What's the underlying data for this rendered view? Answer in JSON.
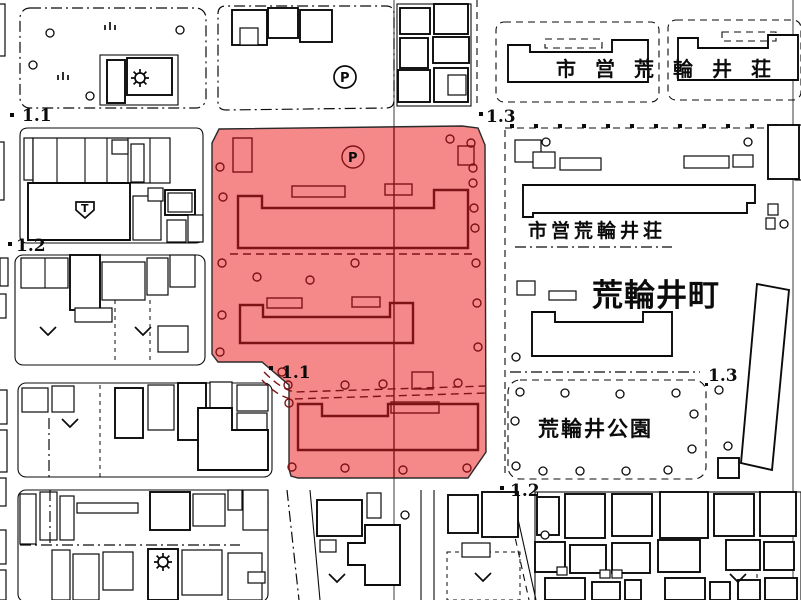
{
  "map": {
    "labels": {
      "housing_top": "市営荒輪井荘",
      "housing_mid": "市営荒輪井荘",
      "town": "荒輪井町",
      "park": "荒輪井公園"
    },
    "markers": [
      {
        "label": "1.1"
      },
      {
        "label": "1.2"
      },
      {
        "label": "1.3"
      },
      {
        "label": "1.1"
      },
      {
        "label": "1.3"
      },
      {
        "label": "1.2"
      }
    ],
    "symbols": {
      "parking": "P",
      "telephone": "T"
    },
    "colors": {
      "highlight_fill": "#f5898a",
      "highlight_line": "#7e1316",
      "line": "#0b0b0b",
      "background": "#ffffff"
    }
  }
}
